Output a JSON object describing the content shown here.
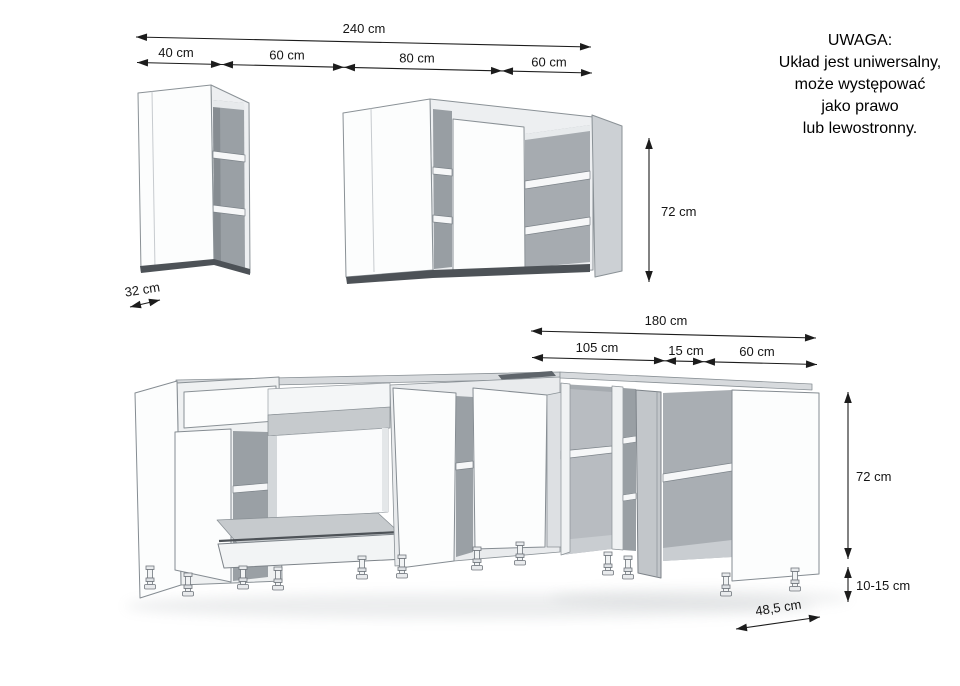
{
  "note": {
    "title": "UWAGA:",
    "line1": "Układ jest uniwersalny,",
    "line2": "może występować",
    "line3": "jako prawo",
    "line4": "lub lewostronny."
  },
  "dimensions": {
    "wall": {
      "total": "240 cm",
      "seg1": "40 cm",
      "seg2": "60 cm",
      "seg3": "80 cm",
      "seg4": "60 cm",
      "height": "72 cm",
      "small_depth": "32 cm"
    },
    "base": {
      "total": "180 cm",
      "seg1": "105 cm",
      "seg2": "15 cm",
      "seg3": "60 cm",
      "height": "72 cm",
      "legs": "10-15 cm",
      "depth": "48,5 cm"
    }
  },
  "colors": {
    "line": "#1c1c1c",
    "face": "#fcfdfd",
    "interior": "#9aa0a5",
    "top_band": "#d7dadd"
  }
}
